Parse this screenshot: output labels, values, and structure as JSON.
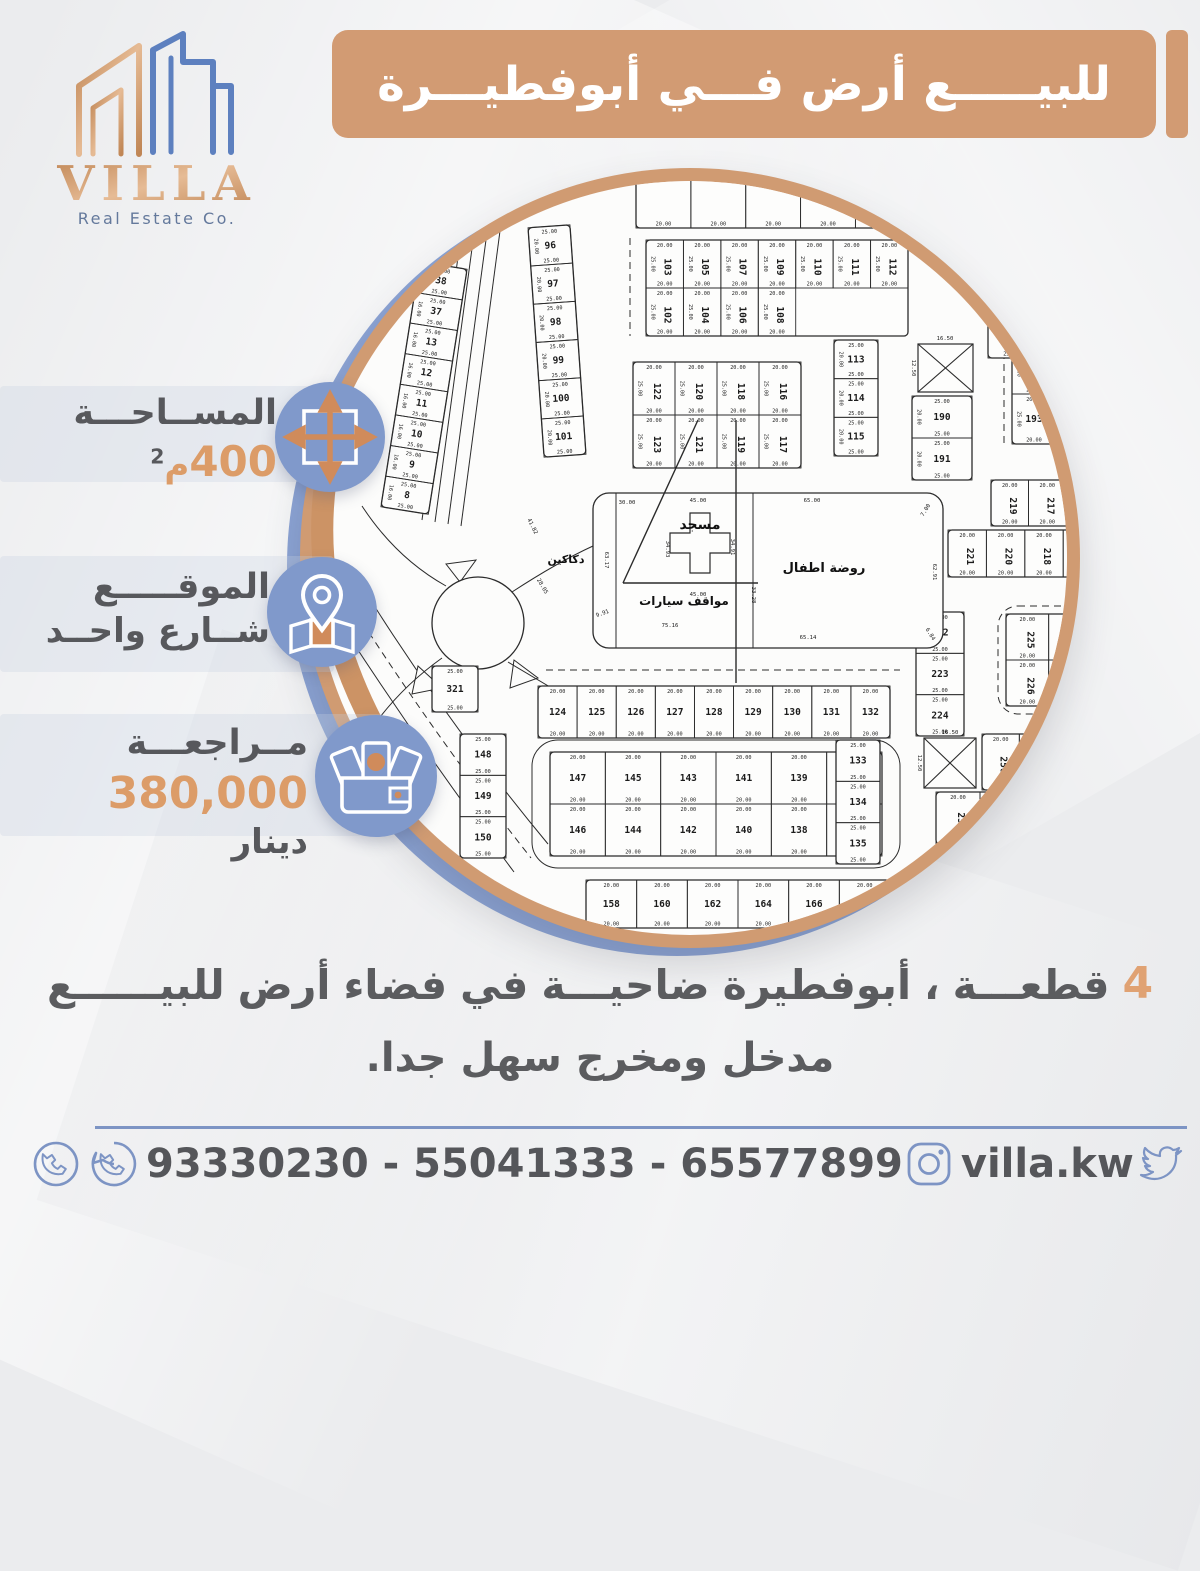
{
  "colors": {
    "tan": "#d29b73",
    "blue": "#8099cb",
    "orange": "#dc9c68",
    "dark": "#57585c",
    "footer_blue": "#7d94c4",
    "map_line": "#2b2b2b",
    "logo_copper": "#cb9166",
    "logo_blue": "#5d80bf"
  },
  "logo": {
    "title": "VILLA",
    "subtitle": "Real Estate Co."
  },
  "banner": {
    "text": "للبيـــــع أرض فـــي أبوفطيـــرة"
  },
  "info": {
    "area_label": "المســاحـــة",
    "area_value": "400",
    "area_unit": "م",
    "area_sup": "2",
    "location_label": "الموقـــــع",
    "location_value": "شــارع واحــد",
    "price_label": "مــراجعـــة",
    "price_value": "380,000",
    "price_unit": "دينار"
  },
  "description": {
    "words": [
      "للبيــــــع",
      "أرض",
      "فضاء",
      "في",
      "ضاحيـــة",
      "أبوفطيرة",
      "،",
      "قطعـــة"
    ],
    "block_number": "4",
    "line2": "مدخل ومخرج سهل جدا."
  },
  "footer": {
    "phones": "93330230 - 55041333 - 65577899",
    "instagram": "villa.kw",
    "social": "villa_kw"
  },
  "map": {
    "labels": [
      {
        "t": "مسجد",
        "x": 400,
        "y": 361,
        "s": 14
      },
      {
        "t": "مواقف  سيارات",
        "x": 384,
        "y": 437,
        "s": 12
      },
      {
        "t": "روضة اطفال",
        "x": 524,
        "y": 404,
        "s": 13
      },
      {
        "t": "دكاكين",
        "x": 266,
        "y": 395,
        "s": 11
      }
    ],
    "blocks": [
      {
        "x": 336,
        "y": -34,
        "w": 384,
        "h": 94,
        "rows": [
          [
            "",
            "",
            "",
            "",
            "",
            "",
            ""
          ]
        ],
        "hdim": "20.00"
      },
      {
        "x": 346,
        "y": 72,
        "w": 262,
        "h": 96,
        "maxCols": 7,
        "rot": 90,
        "hdim": "20.00",
        "vdim": "25.00",
        "rows": [
          [
            "103",
            "105",
            "107",
            "109",
            "110",
            "111",
            "112"
          ],
          [
            "102",
            "104",
            "106",
            "108"
          ]
        ]
      },
      {
        "x": 236,
        "y": 58,
        "w": 42,
        "h": 230,
        "tilt": -4,
        "hdim": "25.00",
        "vdim": "20.00",
        "rows": [
          [
            "96"
          ],
          [
            "97"
          ],
          [
            "98"
          ],
          [
            "99"
          ],
          [
            "100"
          ],
          [
            "101"
          ]
        ]
      },
      {
        "x": 100,
        "y": 96,
        "w": 48,
        "h": 248,
        "tilt": 9,
        "hdim": "25.00",
        "vdim": "16.00",
        "rows": [
          [
            "38"
          ],
          [
            "37"
          ],
          [
            "13"
          ],
          [
            "12"
          ],
          [
            "11"
          ],
          [
            "10"
          ],
          [
            "9"
          ],
          [
            "8"
          ]
        ]
      },
      {
        "x": 534,
        "y": 172,
        "w": 44,
        "h": 116,
        "hdim": "25.00",
        "vdim": "20.00",
        "rows": [
          [
            "113"
          ],
          [
            "114"
          ],
          [
            "115"
          ]
        ]
      },
      {
        "x": 333,
        "y": 194,
        "w": 168,
        "h": 106,
        "rot": 90,
        "hdim": "20.00",
        "vdim": "25.00",
        "rows": [
          [
            "122",
            "120",
            "118",
            "116"
          ],
          [
            "123",
            "121",
            "119",
            "117"
          ]
        ]
      },
      {
        "x": 712,
        "y": 176,
        "w": 132,
        "h": 100,
        "hdim": "20.00",
        "vdim": "25.00",
        "rows": [
          [
            "192",
            "194",
            "196"
          ],
          [
            "193",
            "195",
            "197"
          ]
        ]
      },
      {
        "x": 612,
        "y": 228,
        "w": 60,
        "h": 84,
        "hdim": "25.00",
        "vdim": "20.00",
        "rows": [
          [
            "190"
          ],
          [
            "191"
          ]
        ]
      },
      {
        "x": 688,
        "y": 106,
        "w": 46,
        "h": 84,
        "hdim": "25.00",
        "rows": [
          [
            "189"
          ],
          [
            "188"
          ]
        ]
      },
      {
        "x": 691,
        "y": 312,
        "w": 150,
        "h": 46,
        "rot": 90,
        "hdim": "20.00",
        "rows": [
          [
            "219",
            "217",
            "215",
            "213"
          ]
        ]
      },
      {
        "x": 648,
        "y": 362,
        "w": 192,
        "h": 47,
        "rot": 90,
        "hdim": "20.00",
        "rows": [
          [
            "221",
            "220",
            "218",
            "216",
            "214"
          ]
        ]
      },
      {
        "x": 238,
        "y": 518,
        "w": 352,
        "h": 52,
        "hdim": "20.00",
        "rows": [
          [
            "124",
            "125",
            "126",
            "127",
            "128",
            "129",
            "130",
            "131",
            "132"
          ]
        ]
      },
      {
        "x": 250,
        "y": 584,
        "w": 332,
        "h": 104,
        "hdim": "20.00",
        "rows": [
          [
            "147",
            "145",
            "143",
            "141",
            "139",
            "137"
          ],
          [
            "146",
            "144",
            "142",
            "140",
            "138",
            "136"
          ]
        ]
      },
      {
        "x": 160,
        "y": 566,
        "w": 46,
        "h": 124,
        "hdim": "25.00",
        "rows": [
          [
            "148"
          ],
          [
            "149"
          ],
          [
            "150"
          ]
        ]
      },
      {
        "x": 536,
        "y": 572,
        "w": 44,
        "h": 124,
        "hdim": "25.00",
        "rows": [
          [
            "133"
          ],
          [
            "134"
          ],
          [
            "135"
          ]
        ]
      },
      {
        "x": 286,
        "y": 712,
        "w": 304,
        "h": 48,
        "hdim": "20.00",
        "rows": [
          [
            "158",
            "160",
            "162",
            "164",
            "166",
            "168"
          ]
        ]
      },
      {
        "x": 616,
        "y": 444,
        "w": 48,
        "h": 124,
        "hdim": "25.00",
        "rows": [
          [
            "222"
          ],
          [
            "223"
          ],
          [
            "224"
          ]
        ]
      },
      {
        "x": 706,
        "y": 446,
        "w": 128,
        "h": 92,
        "rot": 90,
        "hdim": "20.00",
        "rows": [
          [
            "225",
            "227",
            "229"
          ],
          [
            "226",
            "228",
            "230"
          ]
        ]
      },
      {
        "x": 682,
        "y": 566,
        "w": 112,
        "h": 56,
        "rot": 90,
        "hdim": "20.00",
        "rows": [
          [
            "250",
            "248",
            "246"
          ]
        ]
      },
      {
        "x": 636,
        "y": 624,
        "w": 88,
        "h": 52,
        "rot": 90,
        "hdim": "20.00",
        "rows": [
          [
            "252",
            "251"
          ]
        ]
      },
      {
        "x": 132,
        "y": 498,
        "w": 46,
        "h": 46,
        "hdim": "25.00",
        "rows": [
          [
            "321"
          ]
        ]
      }
    ],
    "mosque_block": {
      "x": 293,
      "y": 325,
      "w": 350,
      "h": 155,
      "rx": 16,
      "v1": 316,
      "v2": 453,
      "cross": "M390,345 L410,345 L410,365 L430,365 L430,385 L410,385 L410,405 L390,405 L390,385 L370,385 L370,365 L390,365 Z"
    },
    "big4": "M398,252 L323,415 M323,415 L458,415 M436,252 L436,515",
    "roundabout": {
      "x": 178,
      "y": 455,
      "r": 46
    },
    "xboxes": [
      {
        "x": 618,
        "y": 176,
        "w": 55,
        "h": 48
      },
      {
        "x": 624,
        "y": 570,
        "w": 52,
        "h": 50
      }
    ],
    "dims": [
      [
        "30.00",
        327,
        336,
        0
      ],
      [
        "45.00",
        398,
        334,
        0
      ],
      [
        "65.00",
        512,
        334,
        0
      ],
      [
        "7.00",
        627,
        343,
        -58
      ],
      [
        "62.91",
        633,
        404,
        90
      ],
      [
        "6.84",
        629,
        467,
        58
      ],
      [
        "65.14",
        508,
        471,
        0
      ],
      [
        "75.16",
        370,
        459,
        0
      ],
      [
        "9.91",
        303,
        447,
        -20
      ],
      [
        "63.17",
        305,
        392,
        90
      ],
      [
        "33.28",
        452,
        427,
        90
      ],
      [
        "34.93",
        366,
        381,
        90
      ],
      [
        "34.91",
        431,
        379,
        90
      ],
      [
        "45.00",
        398,
        428,
        0
      ],
      [
        "41.82",
        231,
        359,
        64
      ],
      [
        "28.05",
        241,
        419,
        60
      ],
      [
        "16.50",
        645,
        172,
        0
      ],
      [
        "12.50",
        612,
        200,
        90
      ],
      [
        "16.50",
        650,
        566,
        0
      ],
      [
        "12.50",
        618,
        595,
        90
      ]
    ],
    "paths": [
      {
        "d": "M168,16 L122,352"
      },
      {
        "d": "M181,14 L135,354"
      },
      {
        "d": "M194,12 L148,356"
      },
      {
        "d": "M207,10 L161,358"
      },
      {
        "d": "M330,70 L330,168",
        "dash": 1
      },
      {
        "d": "M704,172 L704,278",
        "dash": 1
      },
      {
        "d": "M28,436 Q118,576 214,704"
      },
      {
        "d": "M58,412 Q142,548 248,676"
      },
      {
        "d": "M43,424 Q130,562 231,690",
        "dash": 1
      },
      {
        "d": "M246,502 L600,502",
        "dash": 1
      },
      {
        "d": "M146,396 L176,392 L160,414 Z",
        "fill": 1
      },
      {
        "d": "M118,498 L142,520 L112,526 Z",
        "fill": 1
      },
      {
        "d": "M214,492 L238,510 L210,520 Z",
        "fill": 1
      },
      {
        "d": "M212,424 Q258,394 293,378"
      },
      {
        "d": "M208,494 Q252,520 292,544"
      },
      {
        "d": "M146,418 Q96,390 62,338"
      },
      {
        "d": "M142,490 Q100,520 72,560"
      },
      {
        "d": "M612,340 L612,440",
        "dash": 1
      },
      {
        "d": "M662,100 Q700,84 730,88",
        "dash": 1
      }
    ],
    "rects": [
      {
        "x": 232,
        "y": 572,
        "w": 368,
        "h": 128,
        "rx": 26
      },
      {
        "x": 258,
        "y": 592,
        "w": 316,
        "h": 88,
        "rx": 18,
        "dash": 1
      },
      {
        "x": 698,
        "y": 438,
        "w": 144,
        "h": 108,
        "rx": 20,
        "dash": 1
      }
    ]
  }
}
